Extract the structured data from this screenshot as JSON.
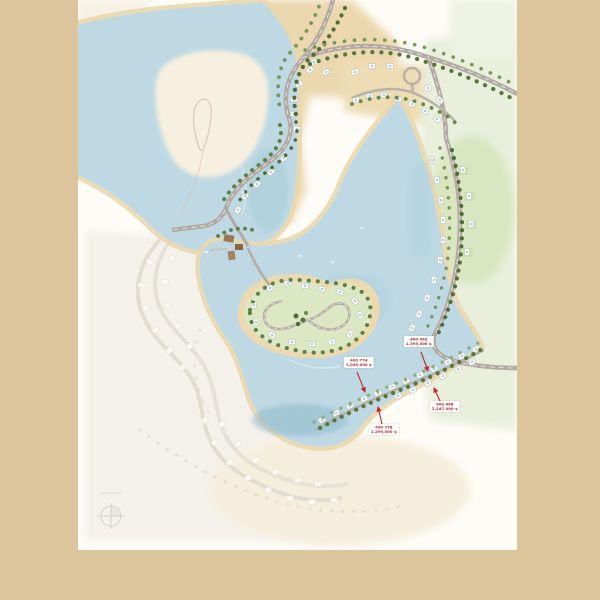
{
  "palette": {
    "frame_background": "#dcc49c",
    "page_background": "#fdfcf7",
    "water": "#bed9e3",
    "water_deep": "#8fb9cb",
    "beach_sand": "#e9d7ae",
    "desert_sand": "#ecd8ae",
    "green_light": "#e9efdb",
    "green_mid": "#d9e6c1",
    "tree_dark": "#4d6c38",
    "tree_mid": "#77975a",
    "road_gray": "#b2aaa2",
    "ghost_phase": "#e0dcd0",
    "building_brown": "#96714d",
    "label_red": "#c1272d"
  },
  "price_labels": [
    {
      "unit": "400 463",
      "price": "1,595,000 $"
    },
    {
      "unit": "400 774",
      "price": "1,049,000 $"
    },
    {
      "unit": "400 778",
      "price": "1,299,000 $"
    },
    {
      "unit": "400 468",
      "price": "2,247,000 $"
    }
  ],
  "icons": {
    "compass": "compass-rose-icon"
  }
}
